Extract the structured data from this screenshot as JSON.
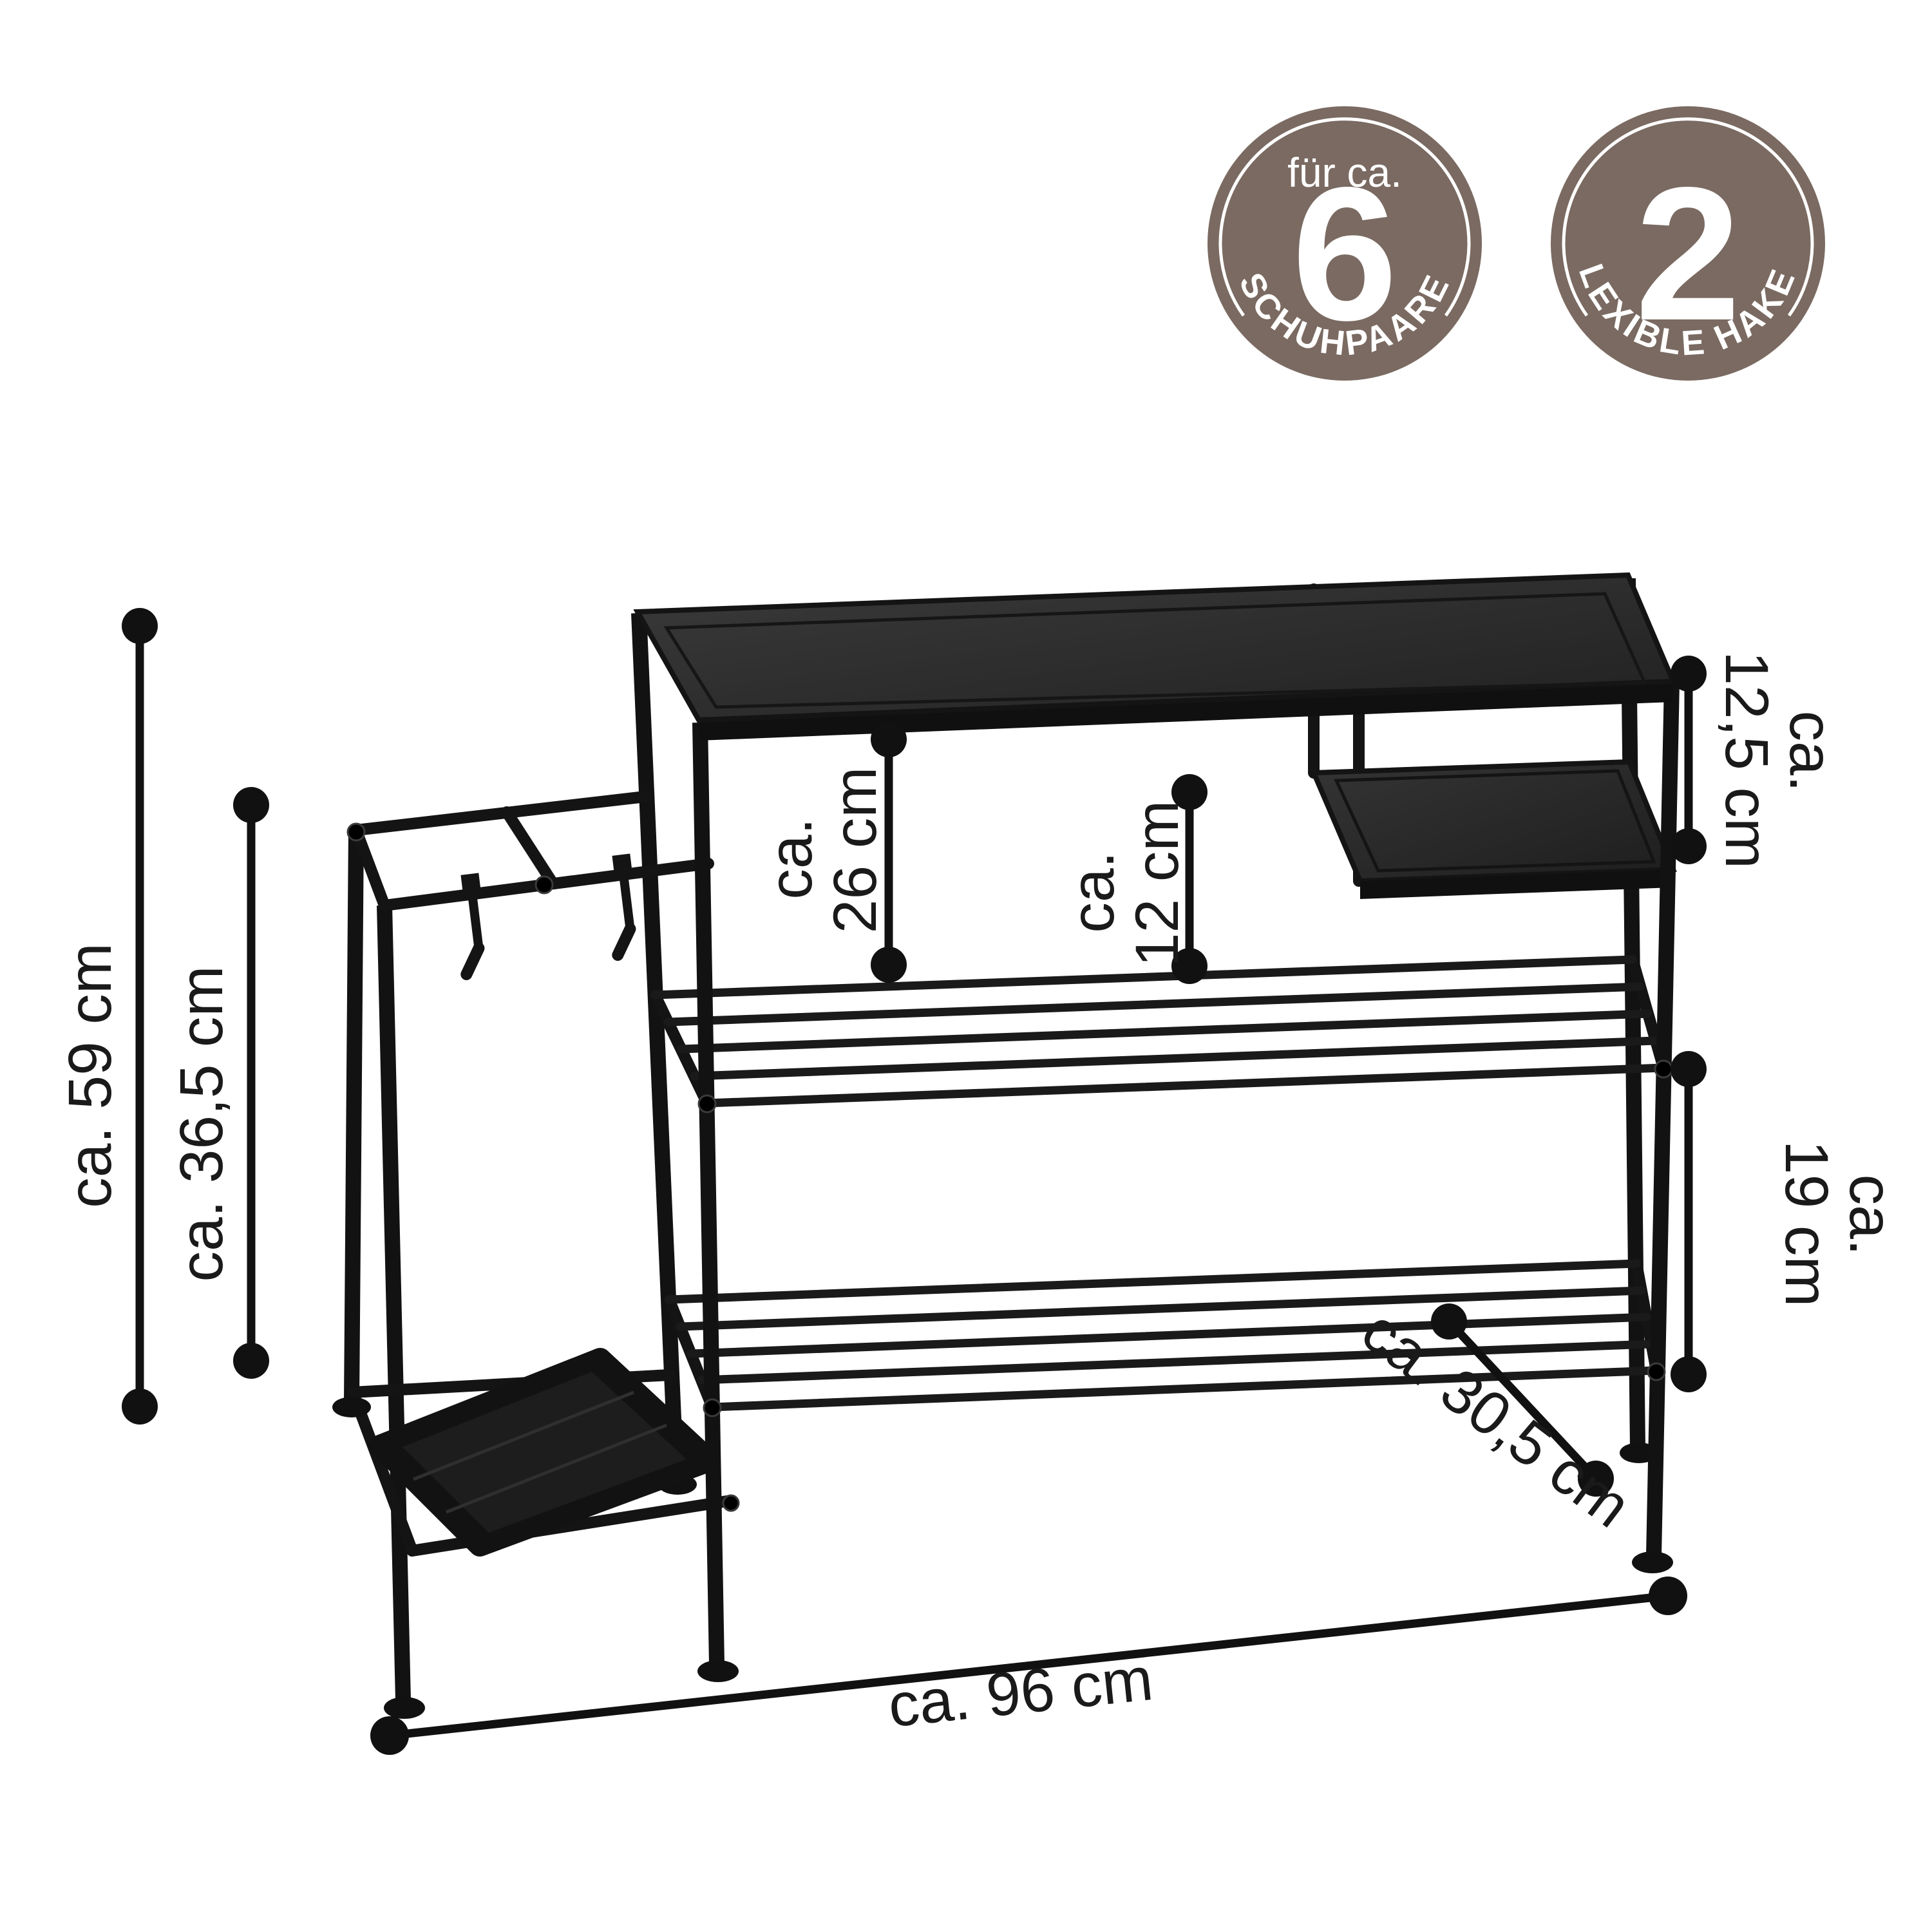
{
  "badges": [
    {
      "top_label": "für ca.",
      "number": "6",
      "arc_label": "SCHUHPAARE"
    },
    {
      "top_label": "",
      "number": "2",
      "arc_label": "FLEXIBLE HAKEN"
    }
  ],
  "badge_style": {
    "bg": "#7a6a61",
    "fg": "#ffffff"
  },
  "dimensions": {
    "total_height": "ca. 59 cm",
    "stand_height": "ca. 36,5 cm",
    "top_clearance": {
      "prefix": "ca.",
      "value": "26 cm"
    },
    "mid_clearance": {
      "prefix": "ca.",
      "value": "12 cm"
    },
    "side_shelf_height": {
      "prefix": "ca.",
      "value": "12,5 cm"
    },
    "shelf_gap": {
      "prefix": "ca.",
      "value": "19 cm"
    },
    "depth": "ca. 30,5 cm",
    "width": "ca. 96 cm"
  },
  "colors": {
    "ink": "#1a1a1a",
    "furniture": "#1a1a1a",
    "badge": "#7a6a61",
    "background": "#ffffff"
  }
}
